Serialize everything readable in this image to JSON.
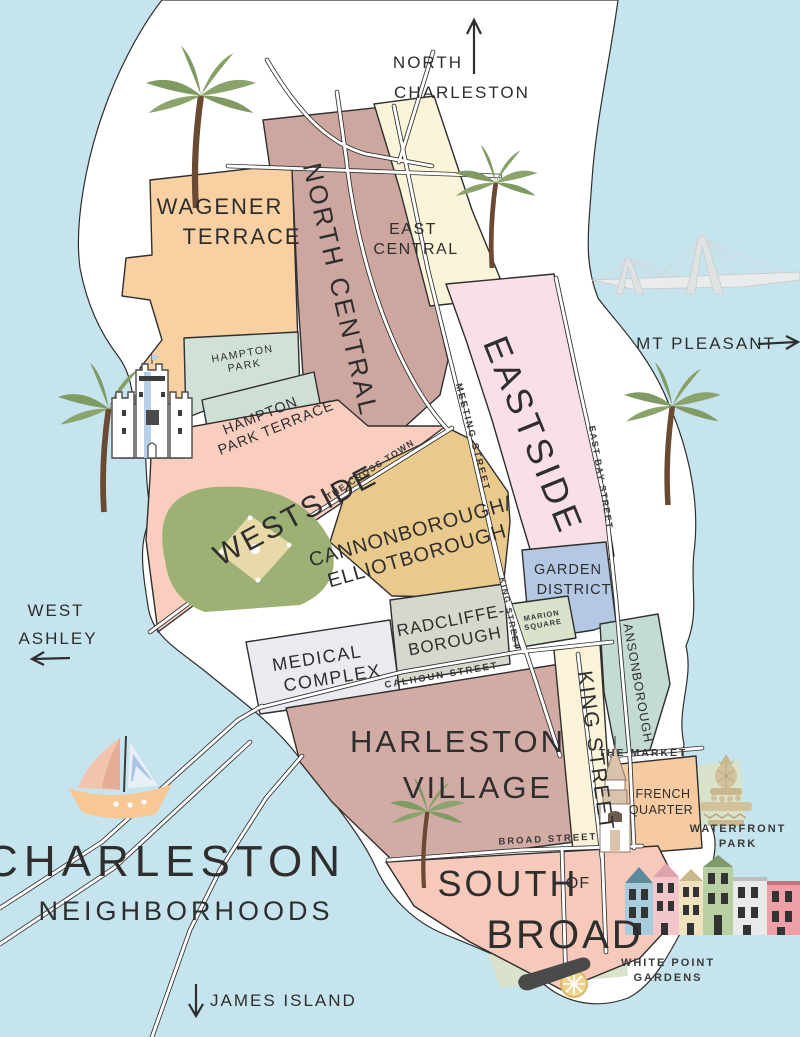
{
  "title": {
    "line1": "CHARLESTON",
    "line2": "NEIGHBORHOODS"
  },
  "directions": {
    "north": {
      "line1": "NORTH",
      "line2": "CHARLESTON"
    },
    "east": {
      "label": "MT PLEASANT"
    },
    "west": {
      "line1": "WEST",
      "line2": "ASHLEY"
    },
    "south": {
      "label": "JAMES ISLAND"
    }
  },
  "neighborhoods": {
    "wagener_terrace": {
      "line1": "WAGENER",
      "line2": "TERRACE",
      "color": "#f8d0a2"
    },
    "north_central": {
      "label": "NORTH CENTRAL",
      "color": "#cda79f"
    },
    "east_central": {
      "line1": "EAST",
      "line2": "CENTRAL",
      "color": "#faf5d8"
    },
    "eastside": {
      "label": "EASTSIDE",
      "color": "#fadfe7"
    },
    "hampton_park": {
      "line1": "HAMPTON",
      "line2": "PARK",
      "color": "#d2e1d7"
    },
    "hampton_park_terrace": {
      "line1": "HAMPTON",
      "line2": "PARK TERRACE",
      "color": "#cfdfd5"
    },
    "westside": {
      "label": "WESTSIDE",
      "color": "#f9cebf"
    },
    "cannonborough_elliotborough": {
      "line1": "CANNONBOROUGH/",
      "line2": "ELLIOTBOROUGH",
      "color": "#eac98c"
    },
    "radcliffeborough": {
      "line1": "RADCLIFFE-",
      "line2": "BOROUGH",
      "color": "#d5d8cc"
    },
    "garden_district": {
      "line1": "GARDEN",
      "line2": "DISTRICT",
      "color": "#b4c8e3"
    },
    "medical_complex": {
      "line1": "MEDICAL",
      "line2": "COMPLEX",
      "color": "#ebeaf1"
    },
    "harleston_village": {
      "line1": "HARLESTON",
      "line2": "VILLAGE",
      "color": "#d2aba5"
    },
    "king_street_district": {
      "label": "KING STREET",
      "color": "#faf3d7"
    },
    "ansonborough": {
      "label": "ANSONBOROUGH",
      "color": "#c3dbd2"
    },
    "french_quarter": {
      "line1": "FRENCH",
      "line2": "QUARTER",
      "color": "#f6cba1"
    },
    "south_of_broad": {
      "line1": "SOUTH",
      "of": "OF",
      "line2": "BROAD",
      "color": "#f7c9ba"
    }
  },
  "streets": {
    "meeting": "MEETING STREET",
    "king": "KING STREET",
    "east_bay": "EAST BAY STREET",
    "calhoun": "CALHOUN STREET",
    "broad": "BROAD STREET",
    "crosstown": "THE CROSS TOWN"
  },
  "landmarks": {
    "marion_square": {
      "line1": "MARION",
      "line2": "SQUARE"
    },
    "the_market": "THE MARKET",
    "waterfront_park": {
      "line1": "WATERFRONT",
      "line2": "PARK"
    },
    "white_point_gardens": {
      "line1": "WHITE POINT",
      "line2": "GARDENS"
    }
  },
  "icons": {
    "palm_tree": "palm-tree-icon",
    "citadel_castle": "citadel-castle-icon",
    "baseball_field": "baseball-field-icon",
    "ravenel_bridge": "ravenel-bridge-icon",
    "sailboat": "sailboat-icon",
    "church_steeple": "church-steeple-icon",
    "pineapple_fountain": "pineapple-fountain-icon",
    "rainbow_row": "rainbow-row-icon",
    "cannon": "cannon-icon"
  },
  "colors": {
    "water": "#c6e4ee",
    "land": "#ffffff",
    "outline": "#2f2f2f",
    "park_green": "#d9e2cb",
    "palm_green": "#7f9a62",
    "text": "#2e2e2e"
  }
}
